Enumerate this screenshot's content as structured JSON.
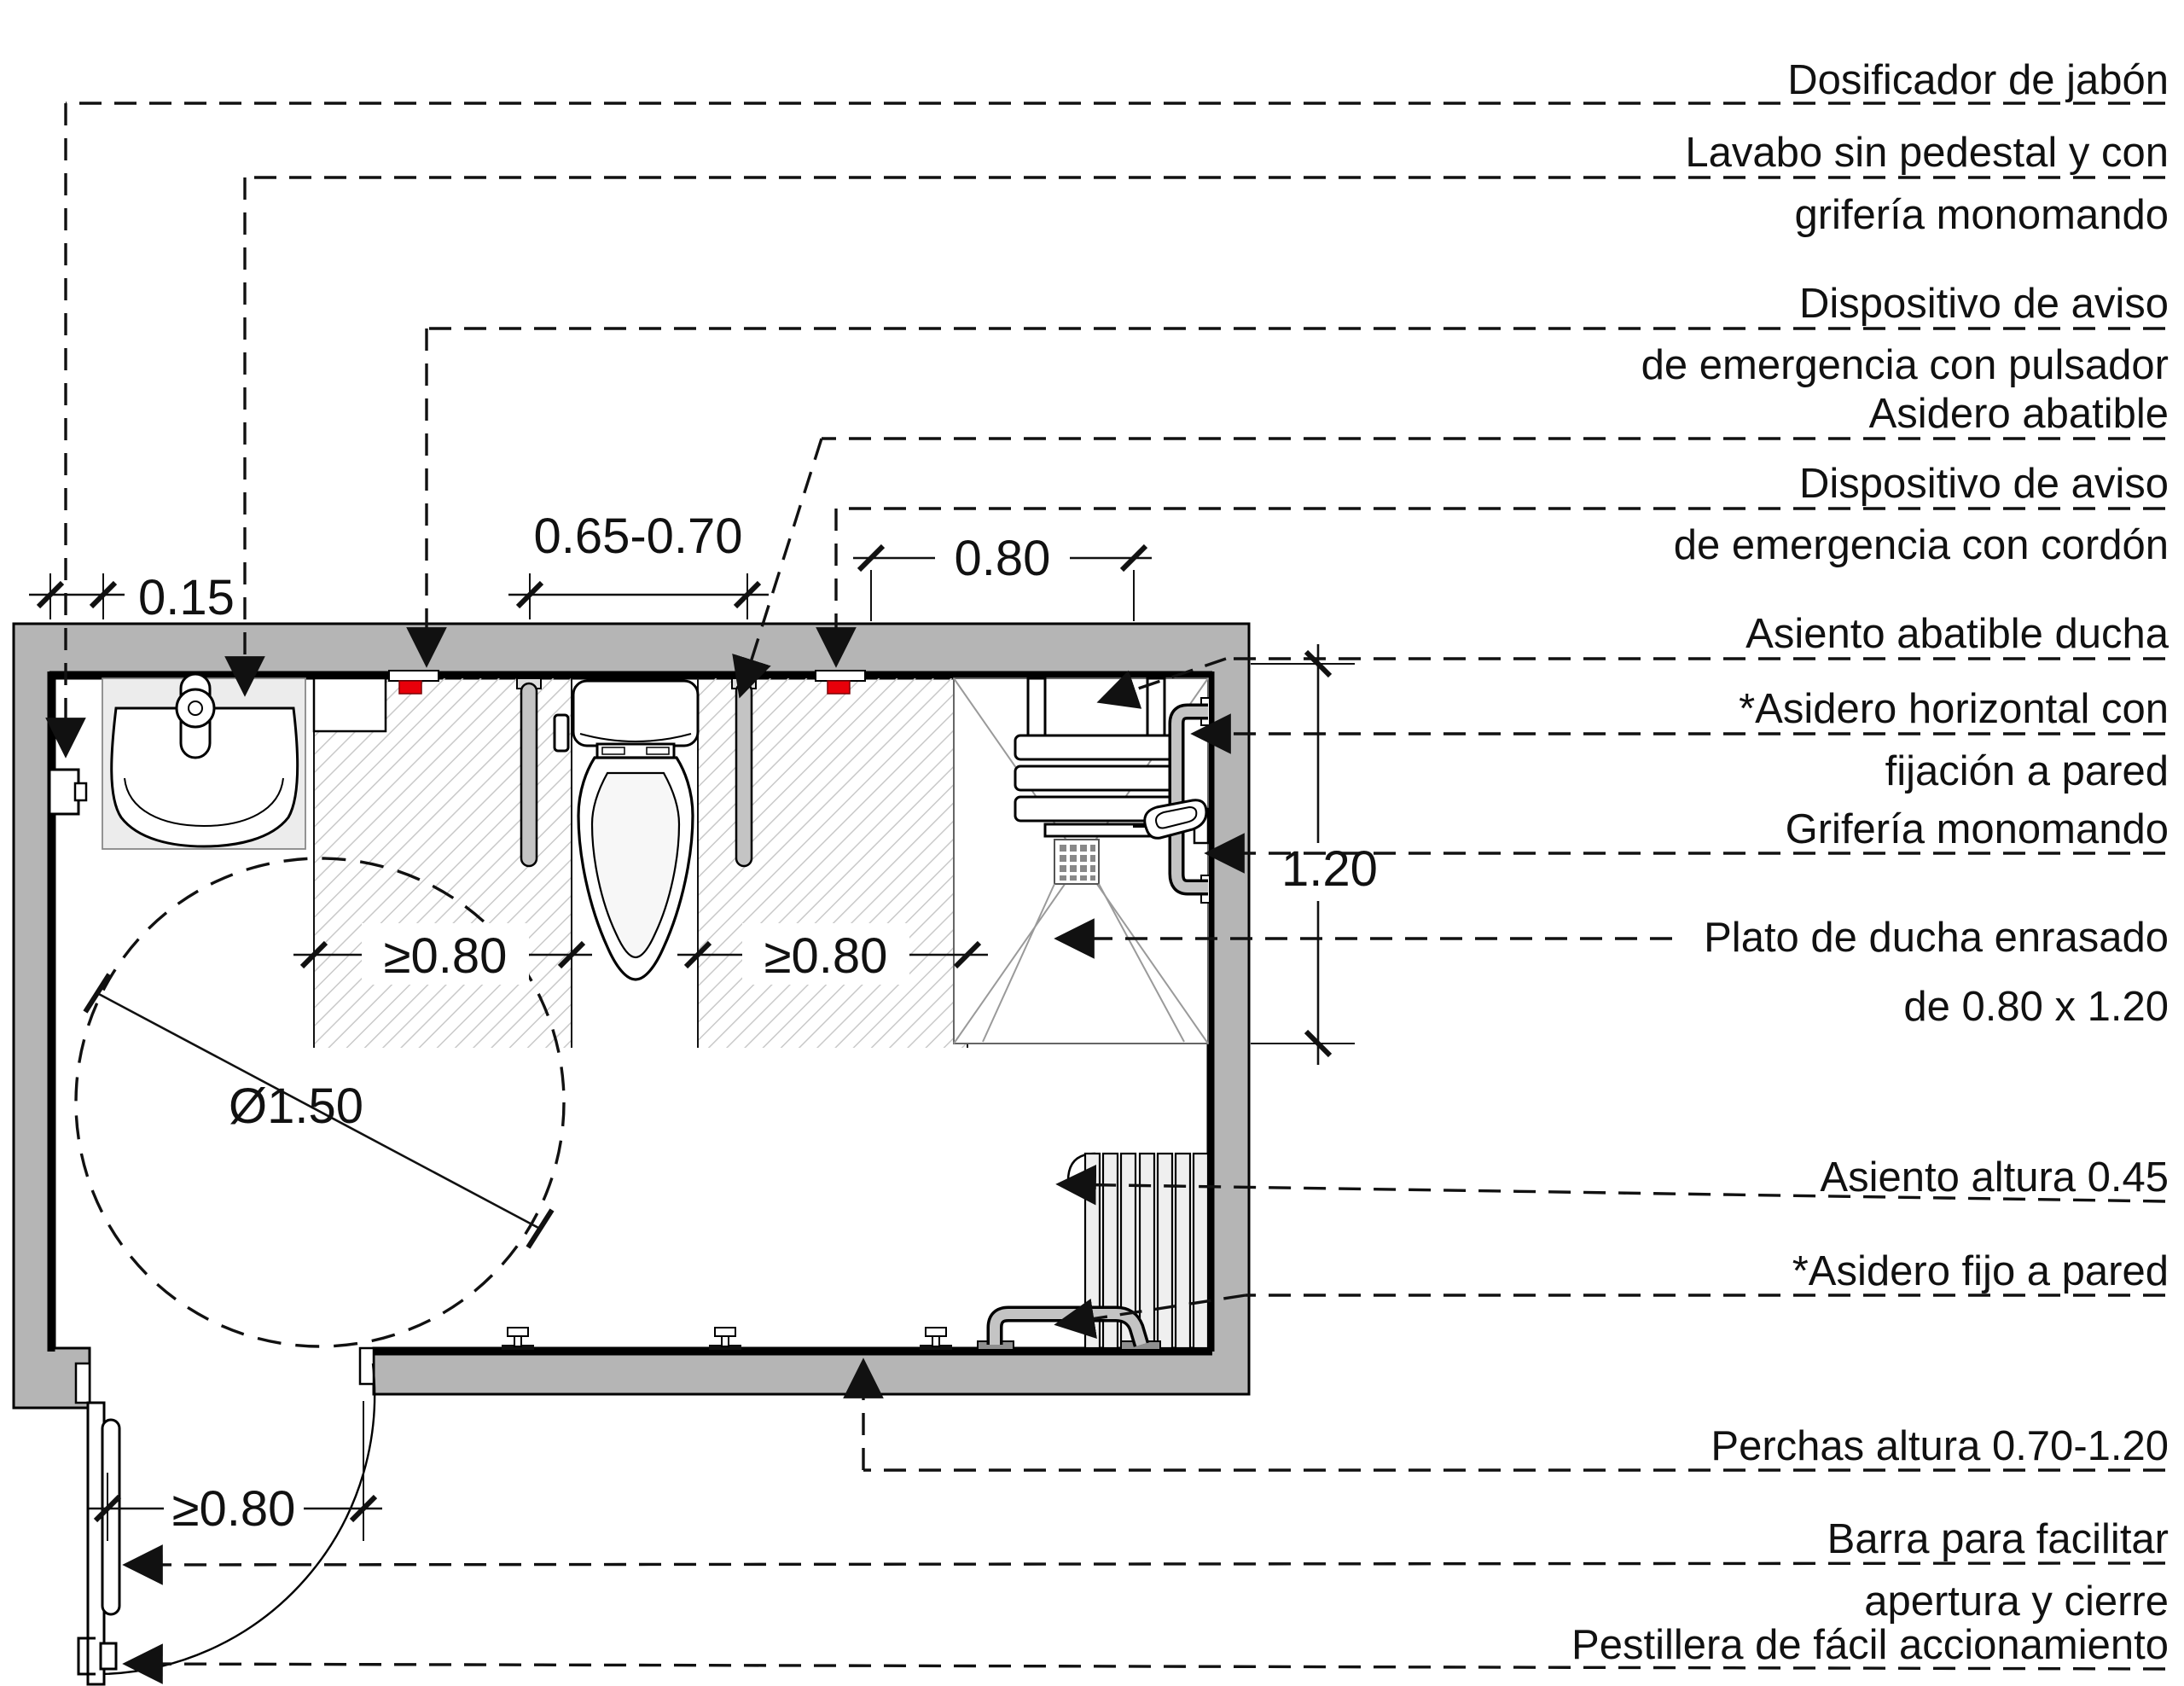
{
  "figure": {
    "type": "floor-plan",
    "subject": "accessible-bathroom-plan"
  },
  "callouts": {
    "soap": {
      "l1": "Dosificador de jabón"
    },
    "lavabo": {
      "l1": "Lavabo sin pedestal y con",
      "l2": "grifería monomando"
    },
    "pulsador": {
      "l1": "Dispositivo de aviso",
      "l2": "de emergencia con pulsador"
    },
    "asidero_abatible": {
      "l1": "Asidero abatible"
    },
    "cordon": {
      "l1": "Dispositivo de aviso",
      "l2": "de emergencia con cordón"
    },
    "asiento_ducha": {
      "l1": "Asiento abatible ducha"
    },
    "asidero_horizontal": {
      "l1": "*Asidero horizontal con",
      "l2": "fijación a pared"
    },
    "griferia": {
      "l1": "Grifería monomando"
    },
    "plato": {
      "l1": "Plato de ducha enrasado",
      "l2": "de 0.80 x 1.20"
    },
    "asiento_altura": {
      "l1": "Asiento altura 0.45"
    },
    "asidero_fijo": {
      "l1": "*Asidero fijo a pared"
    },
    "perchas": {
      "l1": "Perchas altura 0.70-1.20"
    },
    "barra": {
      "l1": "Barra para facilitar",
      "l2": "apertura y cierre"
    },
    "pestillera": {
      "l1": "Pestillera de fácil accionamiento"
    }
  },
  "dims": {
    "soap_offset": "0.15",
    "bar_spacing": "0.65-0.70",
    "shower_width": "0.80",
    "transfer_left": "≥0.80",
    "transfer_right": "≥0.80",
    "door_width": "≥0.80",
    "turning_circle": "Ø1.50",
    "shower_depth": "1.20"
  },
  "colors": {
    "wall": "#b5b5b5",
    "emergency_red": "#e8000a",
    "hatch": "#c9c9c9",
    "counter": "#ececec",
    "tube": "#c4c4c4",
    "slat": "#efefef"
  }
}
